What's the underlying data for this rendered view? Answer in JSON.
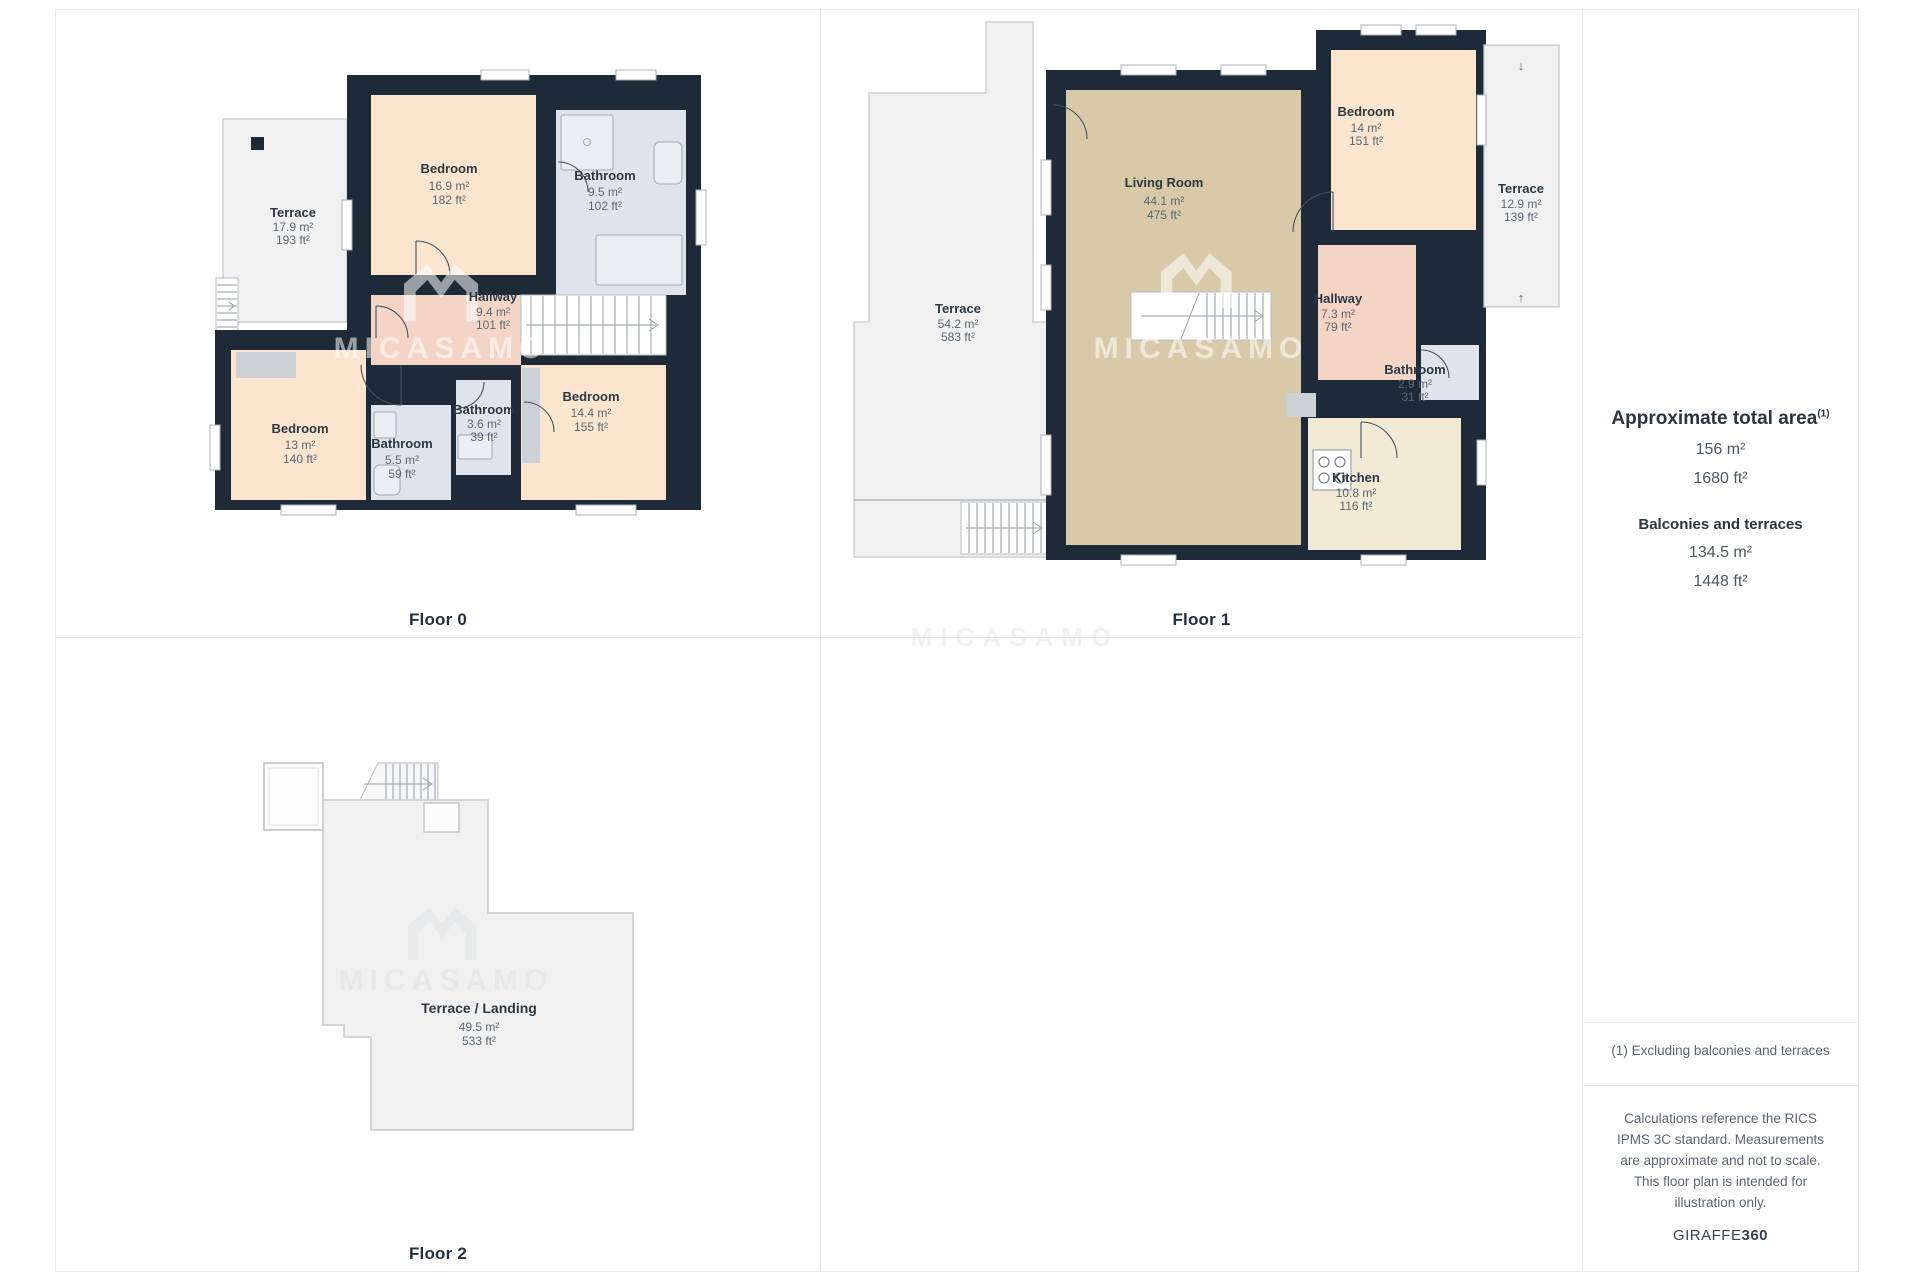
{
  "watermark": {
    "text": "MICASAMO"
  },
  "icons": {
    "arrow_down": "↓",
    "arrow_up": "↑"
  },
  "floors": [
    {
      "label": "Floor 0",
      "rooms": [
        {
          "name": "Terrace",
          "area_m2": "17.9 m²",
          "area_ft2": "193 ft²"
        },
        {
          "name": "Bedroom",
          "area_m2": "16.9 m²",
          "area_ft2": "182 ft²"
        },
        {
          "name": "Bathroom",
          "area_m2": "9.5 m²",
          "area_ft2": "102 ft²"
        },
        {
          "name": "Hallway",
          "area_m2": "9.4 m²",
          "area_ft2": "101 ft²"
        },
        {
          "name": "Bedroom",
          "area_m2": "13 m²",
          "area_ft2": "140 ft²"
        },
        {
          "name": "Bathroom",
          "area_m2": "5.5 m²",
          "area_ft2": "59 ft²"
        },
        {
          "name": "Bathroom",
          "area_m2": "3.6 m²",
          "area_ft2": "39 ft²"
        },
        {
          "name": "Bedroom",
          "area_m2": "14.4 m²",
          "area_ft2": "155 ft²"
        }
      ]
    },
    {
      "label": "Floor 1",
      "rooms": [
        {
          "name": "Terrace",
          "area_m2": "54.2 m²",
          "area_ft2": "583 ft²"
        },
        {
          "name": "Living Room",
          "area_m2": "44.1 m²",
          "area_ft2": "475 ft²"
        },
        {
          "name": "Bedroom",
          "area_m2": "14 m²",
          "area_ft2": "151 ft²"
        },
        {
          "name": "Terrace",
          "area_m2": "12.9 m²",
          "area_ft2": "139 ft²"
        },
        {
          "name": "Hallway",
          "area_m2": "7.3 m²",
          "area_ft2": "79 ft²"
        },
        {
          "name": "Bathroom",
          "area_m2": "2.9 m²",
          "area_ft2": "31 ft²"
        },
        {
          "name": "Kitchen",
          "area_m2": "10.8 m²",
          "area_ft2": "116 ft²"
        }
      ]
    },
    {
      "label": "Floor 2",
      "rooms": [
        {
          "name": "Terrace / Landing",
          "area_m2": "49.5 m²",
          "area_ft2": "533 ft²"
        }
      ]
    }
  ],
  "sidebar": {
    "total_title": "Approximate total area",
    "total_superscript": "(1)",
    "total_m2": "156 m²",
    "total_ft2": "1680 ft²",
    "balconies_title": "Balconies and terraces",
    "balconies_m2": "134.5 m²",
    "balconies_ft2": "1448 ft²",
    "footnote": "(1) Excluding balconies and terraces",
    "disclaimer": "Calculations reference the RICS IPMS 3C standard. Measurements are approximate and not to scale. This floor plan is intended for illustration only.",
    "brand": "GIRAFFE",
    "brand_bold": "360"
  },
  "colors": {
    "wall": "#1e2a38",
    "bedroom": "#fce5cf",
    "bathroom": "#dfe4ec",
    "living_room": "#d8caa8",
    "kitchen": "#f1e9d3",
    "hallway": "#f4d5c5",
    "terrace": "#f0f0f1",
    "closet_gray": "#ccd1d6",
    "text_dark": "#2c3844",
    "text_gray": "#5c6772"
  }
}
